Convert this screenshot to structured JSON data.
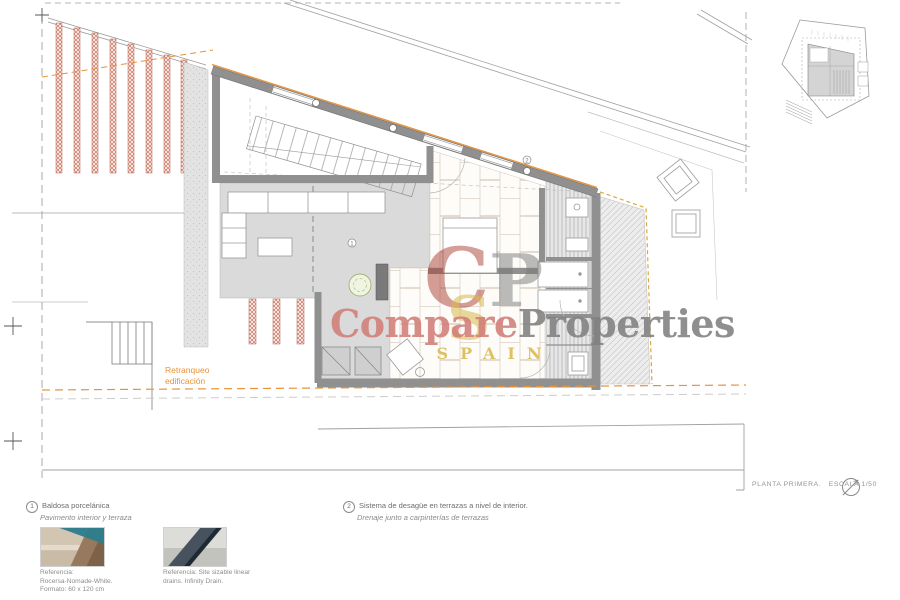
{
  "watermark": {
    "brand_primary": "Compare",
    "brand_secondary": "Properties",
    "brand_sub": "SPAIN",
    "monogram_c": "C",
    "monogram_p": "P",
    "monogram_s": "S"
  },
  "plan": {
    "setback_label_line1": "Retranqueo",
    "setback_label_line2": "edificación",
    "marker_1": "1",
    "marker_2": "2"
  },
  "titleblock": {
    "sheet_title": "PLANTA PRIMERA.",
    "scale_label": "ESCALA 1/50"
  },
  "legend": {
    "item1": {
      "number": "1",
      "title": "Baldosa porcelánica",
      "subtitle": "Pavimento interior y terraza",
      "caption_line1": "Referencia:",
      "caption_line2": "Rocersa-Nomade-White.",
      "caption_line3": "Formato: 60 x 120 cm"
    },
    "item2": {
      "number": "2",
      "title": "Sistema de desagüe en terrazas a nivel de interior.",
      "subtitle": "Drenaje junto a carpinterías de terrazas",
      "caption_line1": "Referencia: Site sizable linear",
      "caption_line2": "drains. Infinity Drain."
    }
  },
  "colors": {
    "accent_orange": "#e8923a",
    "terrace_dash_gold": "#d9a93f",
    "hatch_red": "#c4604a",
    "wall_gray": "#909090",
    "brand_red": "#a93e34",
    "brand_salmon": "#d07d76",
    "brand_gray": "#808080",
    "brand_gold": "#d9b64a"
  }
}
